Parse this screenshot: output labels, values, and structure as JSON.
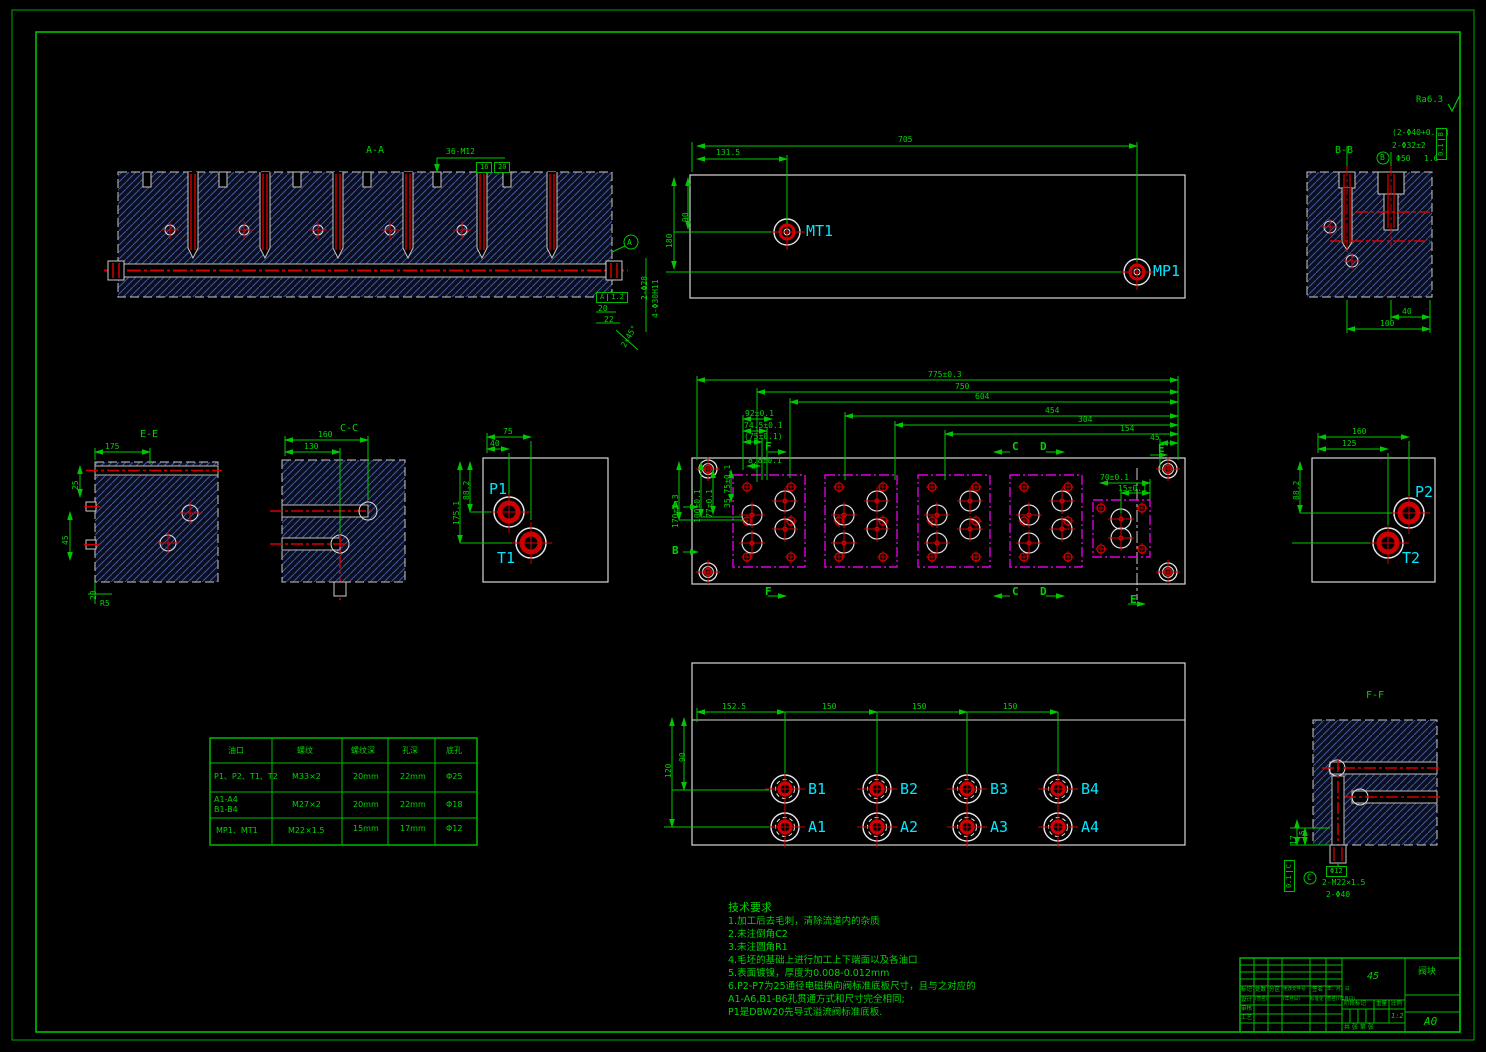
{
  "colors": {
    "background": "#000000",
    "dim_green": "#00c800",
    "text_green": "#00d400",
    "port_cyan": "#00e8ff",
    "channel_red": "#d40000",
    "valve_magenta": "#dd00dd",
    "hatch_blue": "#44579b",
    "outline_white": "#d9d9d9"
  },
  "rough": {
    "note": "Ra6.3"
  },
  "aa": {
    "label": "A-A",
    "thread": "36-M12",
    "depth1": "16",
    "depth2": "20",
    "datum": "A",
    "tol_val": "1.2",
    "call1": "2-Φ28",
    "call2": "4-Φ30H11",
    "dim20": "20",
    "dim22": "22",
    "chamfer": "2×45°"
  },
  "top": {
    "d705": "705",
    "d1315": "131.5",
    "d90": "90",
    "d180": "180",
    "mt1": "MT1",
    "mp1": "MP1"
  },
  "bb": {
    "label": "B-B",
    "datum": "B",
    "call1": "(2-Φ40+0.16)",
    "call2": "2-Φ32±2",
    "call3": "Φ50",
    "rough": "1.6",
    "tol": "0.1",
    "tol_datum": "B",
    "d40": "40",
    "d100": "100"
  },
  "ee": {
    "label": "E-E",
    "d175": "175",
    "d25": "25",
    "d45": "45",
    "d20": "20",
    "r5": "R5"
  },
  "cc": {
    "label": "C-C",
    "d160": "160",
    "d130": "130"
  },
  "p1": {
    "p1": "P1",
    "t1": "T1",
    "d75": "75",
    "d40": "40",
    "d882": "88.2",
    "d1751": "175.1"
  },
  "cv": {
    "d775": "775±0.3",
    "d750": "750",
    "d604": "604",
    "d454": "454",
    "d304": "304",
    "d154": "154",
    "d45": "45",
    "d92": "92±0.1",
    "d745": "74.5±0.1",
    "d75": "(75±0.1)",
    "d88": "8.8±0.1",
    "d3575": "35.75±0.1",
    "d77": "77±0.1",
    "d100": "100±0.1",
    "d170": "170±0.3",
    "d70": "70±0.1",
    "d15": "15±0.1",
    "sF": "F",
    "sC": "C",
    "sD": "D",
    "sE": "E",
    "sA": "A",
    "sB": "B"
  },
  "bv": {
    "d1525": "152.5",
    "d150a": "150",
    "d150b": "150",
    "d150c": "150",
    "d90": "90",
    "d120": "120",
    "b1": "B1",
    "b2": "B2",
    "b3": "B3",
    "b4": "B4",
    "a1": "A1",
    "a2": "A2",
    "a3": "A3",
    "a4": "A4"
  },
  "p2": {
    "p2": "P2",
    "t2": "T2",
    "d160": "160",
    "d125": "125",
    "d882": "88.2"
  },
  "ff": {
    "label": "F-F",
    "d17": "17",
    "d15": "15",
    "callbox": "Φ12",
    "call1": "2-M22×1.5",
    "call2": "2-Φ40",
    "tol": "0.1",
    "tol_datum": "C",
    "datum": "C"
  },
  "table": {
    "headers": [
      "油口",
      "螺纹",
      "螺纹深",
      "孔深",
      "底孔"
    ],
    "rows": [
      [
        "P1、P2、T1、T2",
        "M33×2",
        "20mm",
        "22mm",
        "Φ25"
      ],
      [
        "A1-A4\nB1-B4",
        "M27×2",
        "20mm",
        "22mm",
        "Φ18"
      ],
      [
        "MP1、MT1",
        "M22×1.5",
        "15mm",
        "17mm",
        "Φ12"
      ]
    ]
  },
  "tech": {
    "title": "技术要求",
    "lines": [
      "1.加工后去毛刺，清除流道内的杂质",
      "2.未注倒角C2",
      "3.未注圆角R1",
      "4.毛坯的基础上进行加工上下端面以及各油口",
      "5.表面镀镍，厚度为0.008-0.012mm",
      "6.P2-P7为25通径电磁换向阀标准底板尺寸，且与之对应的",
      "A1-A6,B1-B6孔贯通方式和尺寸完全相同;",
      "P1是DBW20先导式溢流阀标准底板."
    ]
  },
  "tb": {
    "material": "45",
    "name": "阀块",
    "scale": "1:2",
    "size": "A0",
    "rev": [
      "标记",
      "处数",
      "分区",
      "更改文件号",
      "签名",
      "年、月、日"
    ],
    "design": [
      "设计",
      "(签名)",
      "(年月日)",
      "标准化",
      "(签名)",
      "(年月日)"
    ],
    "check": "审核",
    "process": "工艺",
    "stage": "阶段标记",
    "weight": "重量",
    "ratio": "比例",
    "sheet": "共 张 第 张"
  }
}
